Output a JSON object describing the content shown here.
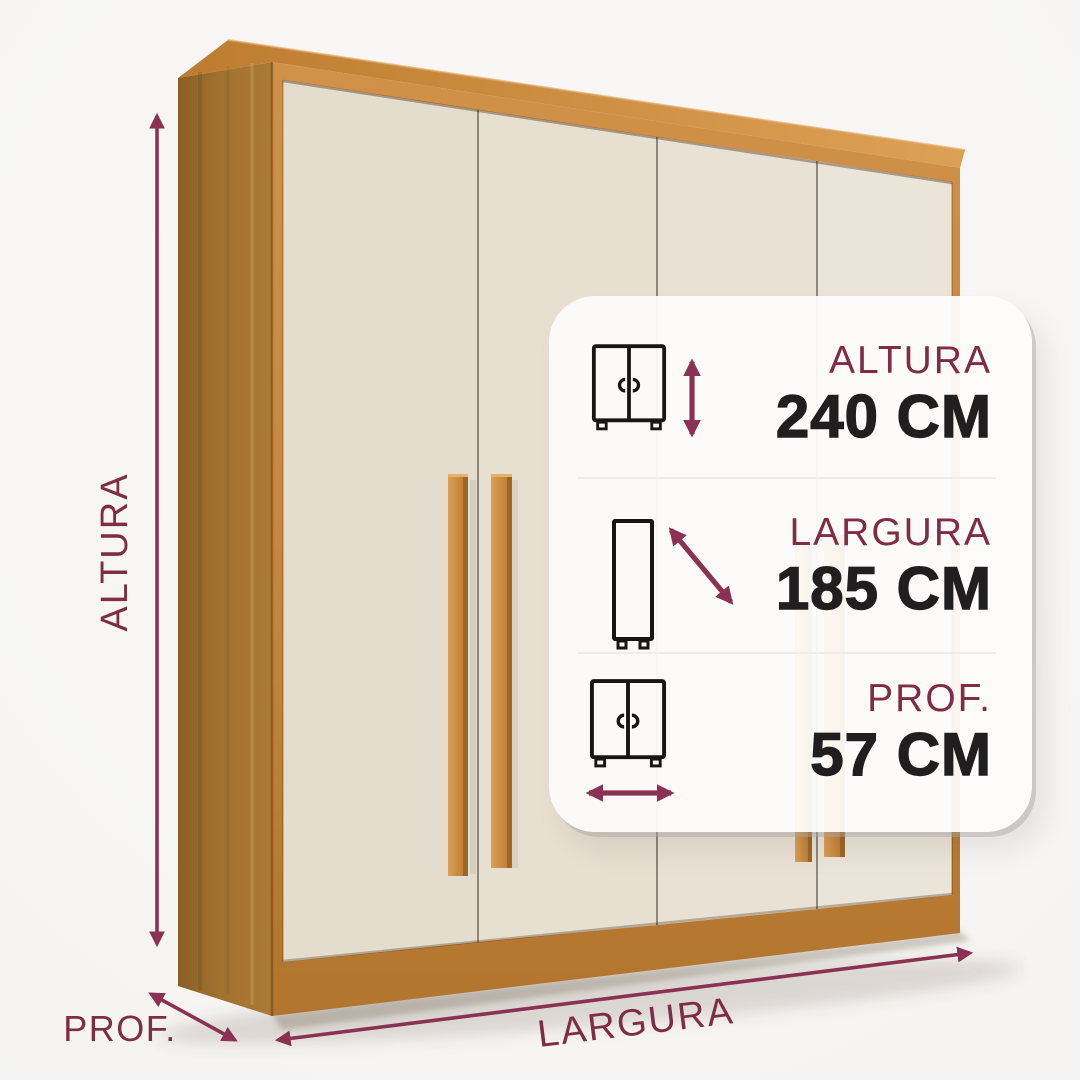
{
  "scene": {
    "height_label": "ALTURA",
    "depth_label": "PROF.",
    "width_label": "LARGURA"
  },
  "card": {
    "rows": [
      {
        "label": "ALTURA",
        "value": "240 CM",
        "icon": "wardrobe-front-icon",
        "arrow": "vertical-double-arrow-icon"
      },
      {
        "label": "LARGURA",
        "value": "185 CM",
        "icon": "cabinet-side-icon",
        "arrow": "diagonal-double-arrow-icon"
      },
      {
        "label": "PROF.",
        "value": "57 CM",
        "icon": "wardrobe-front-icon",
        "arrow": "horizontal-double-arrow-icon"
      }
    ]
  },
  "colors": {
    "accent_arrow": "#8B3153",
    "accent_label": "#7E2C47",
    "value_text": "#211E20",
    "wood": "#C8873D",
    "wood_dark": "#96662A",
    "door_cream": "#E7DFD0",
    "card_background": "#FDFCFB",
    "page_background": "#F5F4F2"
  }
}
